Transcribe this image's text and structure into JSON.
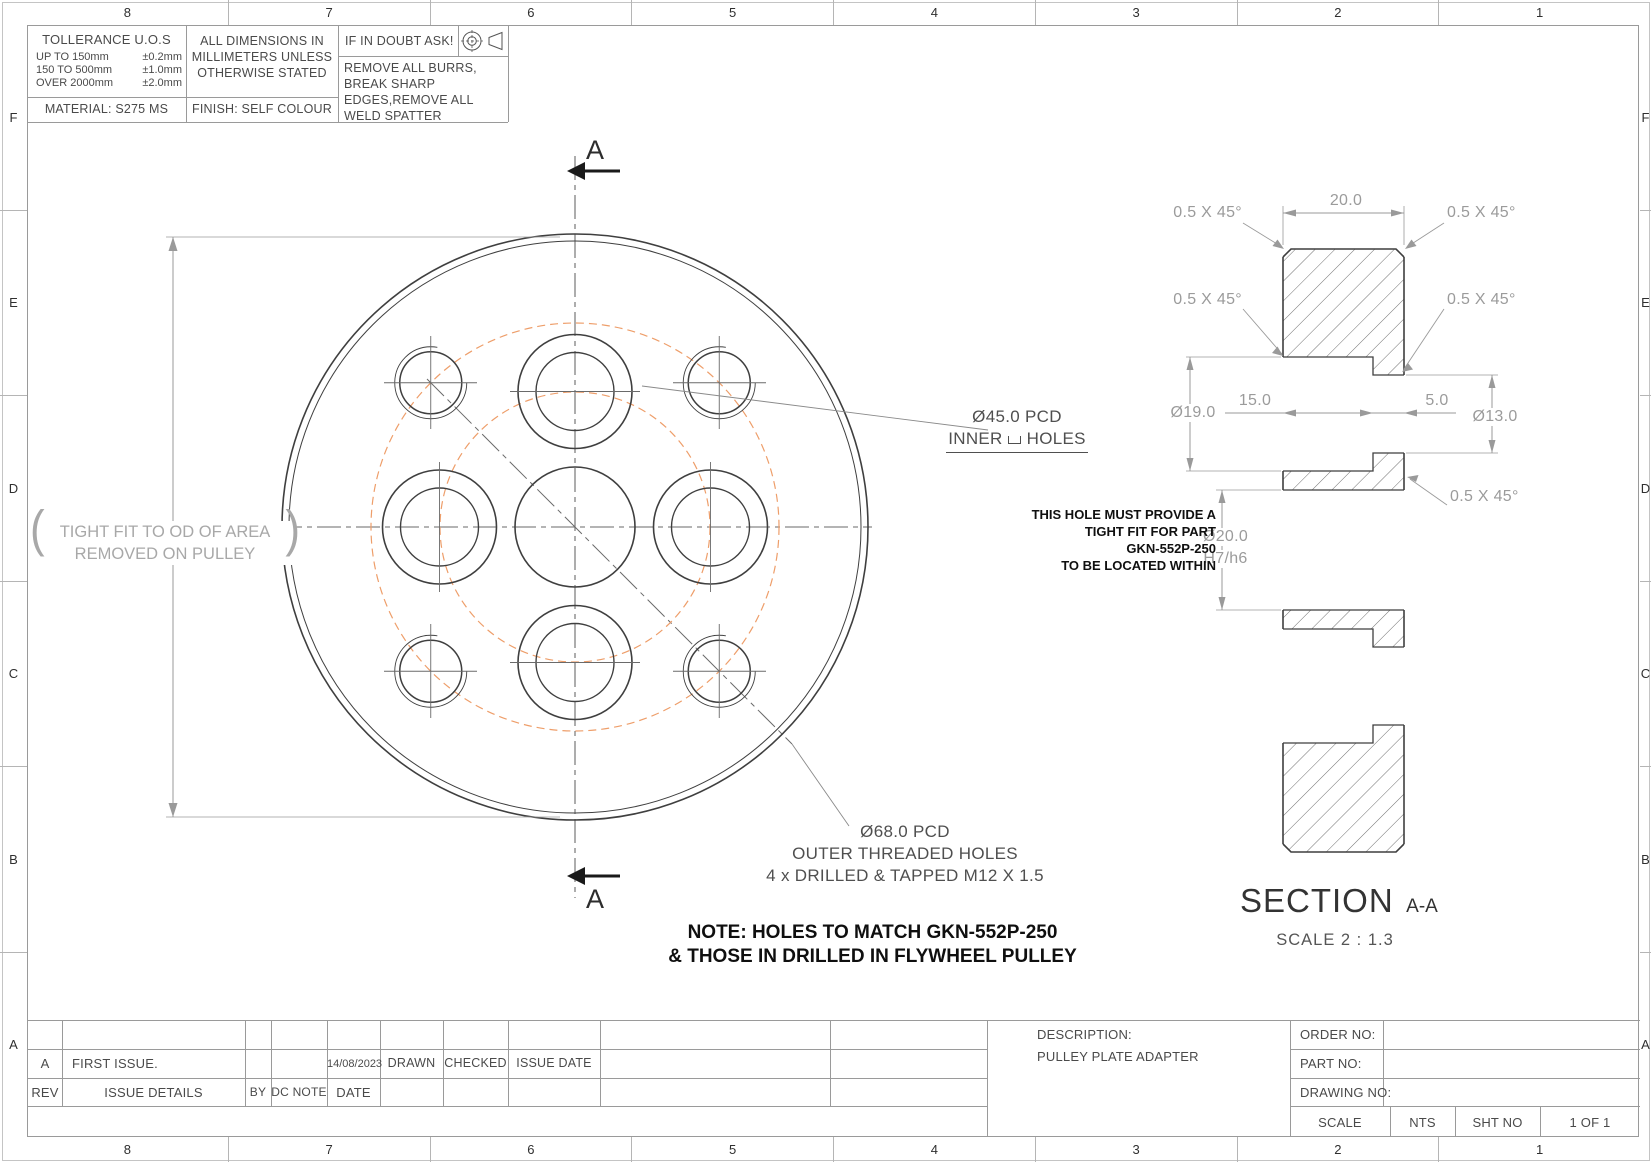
{
  "sheet": {
    "zone_numbers": [
      "8",
      "7",
      "6",
      "5",
      "4",
      "3",
      "2",
      "1"
    ],
    "zone_letters": [
      "F",
      "E",
      "D",
      "C",
      "B",
      "A"
    ]
  },
  "info_block": {
    "tolerance_title": "TOLLERANCE U.O.S",
    "tol_rows": [
      {
        "range": "UP TO 150mm",
        "value": "±0.2mm"
      },
      {
        "range": "150 TO 500mm",
        "value": "±1.0mm"
      },
      {
        "range": "OVER 2000mm",
        "value": "±2.0mm"
      }
    ],
    "material": "MATERIAL: S275 MS",
    "dims_note_l1": "ALL DIMENSIONS IN",
    "dims_note_l2": "MILLIMETERS UNLESS",
    "dims_note_l3": "OTHERWISE STATED",
    "finish": "FINISH: SELF COLOUR",
    "doubt": "IF IN DOUBT ASK!",
    "burrs_note": "REMOVE ALL BURRS, BREAK SHARP EDGES,REMOVE ALL WELD SPATTER",
    "projection_icon": "first-angle-projection"
  },
  "front_view": {
    "section_marker": "A",
    "od_note": {
      "open": "(",
      "line1": "TIGHT FIT TO OD OF AREA",
      "line2": "REMOVED ON PULLEY",
      "close": ")"
    },
    "pcd_inner": {
      "dia": "Ø45.0 PCD",
      "prefix": "INNER",
      "counterbore_icon": "counterbore-symbol",
      "suffix": "HOLES"
    },
    "pcd_outer": {
      "dia": "Ø68.0 PCD",
      "line2": "OUTER THREADED HOLES",
      "line3": "4 x DRILLED & TAPPED M12 X 1.5"
    },
    "note_line1": "NOTE: HOLES TO MATCH GKN-552P-250",
    "note_line2": "& THOSE IN DRILLED IN FLYWHEEL PULLEY"
  },
  "section_view": {
    "title": "SECTION",
    "title_suffix": "A-A",
    "scale_note": "SCALE  2 : 1.3",
    "dims": {
      "width": "20.0",
      "cb_depth": "15.0",
      "land": "5.0",
      "cb_dia": "Ø19.0",
      "thru_dia": "Ø13.0",
      "bore_dia": "Ø20.0",
      "bore_fit": "H7/h6",
      "chamfer": "0.5 X 45°"
    },
    "fit_note": {
      "l1": "THIS HOLE MUST PROVIDE A",
      "l2": "TIGHT FIT FOR PART",
      "l3": "GKN-552P-250",
      "l4": "TO BE LOCATED WITHIN"
    }
  },
  "title_block": {
    "rev_entry": {
      "rev": "A",
      "details": "FIRST ISSUE.",
      "date": "14/08/2023",
      "drawn": "DRAWN",
      "checked": "CHECKED",
      "issue_date": "ISSUE DATE"
    },
    "rev_header": {
      "rev": "REV",
      "details": "ISSUE DETAILS",
      "by": "BY",
      "dc_note": "DC NOTE",
      "date": "DATE"
    },
    "description_label": "DESCRIPTION:",
    "description_value": "PULLEY PLATE ADAPTER",
    "order_label": "ORDER NO:",
    "part_label": "PART NO:",
    "drawing_label": "DRAWING NO:",
    "scale_label": "SCALE",
    "scale_value": "NTS",
    "sht_label": "SHT NO",
    "sht_value": "1  OF 1"
  }
}
